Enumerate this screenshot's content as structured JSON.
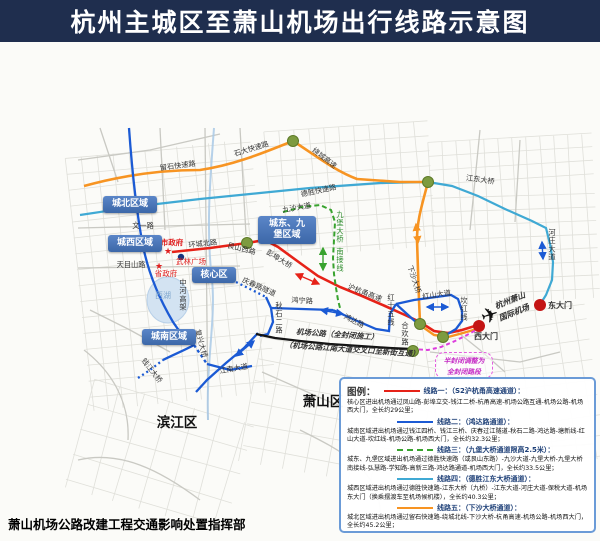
{
  "header": {
    "title": "杭州主城区至萧山机场出行线路示意图"
  },
  "footer": {
    "issuer": "萧山机场公路改建工程交通影响处置指挥部"
  },
  "legend": {
    "title": "图例：",
    "routes": [
      {
        "name": "线路一：（S2沪杭甬高速通道）：",
        "style": "solid",
        "color": "#e62218",
        "desc": "核心区进出机场通过凤山路-彭埠立交-钱江二桥-杭甬高速-机场公路互通-机场公路-机场西大门，全长约29公里；"
      },
      {
        "name": "线路二：（鸿达路通道）：",
        "style": "solid",
        "color": "#1b5ad4",
        "desc": "城南区域进出机场通过钱江四桥、钱江三桥、庆春过江隧道-秋石二路-鸿达路-塘新线-红山大道-坎红线-机场公路-机场西大门，全长约32.3公里；"
      },
      {
        "name": "线路三：（九堡大桥通道限高2.5米）：",
        "style": "dashed",
        "color": "#38a32e",
        "desc": "城东、九堡区域进出机场通过德胜快速路（或艮山东路）-九沙大道-九堡大桥-九堡大桥南接线-弘慧路-学知路-高新三路-鸿达路通道-机场西大门，全长约33.5公里；"
      },
      {
        "name": "线路四：（德胜江东大桥通道）：",
        "style": "solid",
        "color": "#3fa9d4",
        "desc": "城西区域进出机场通过德胜快速路-江东大桥（九桥）-江东大道-河庄大道-保税大道-机场东大门（换乘摆渡车至机场候机楼），全长约40.3公里；"
      },
      {
        "name": "线路五：（下沙大桥通道）：",
        "style": "solid",
        "color": "#f79422",
        "desc": "城北区域进出机场通过留石快速路-绕城北线-下沙大桥-杭甬高速-机场公路-机场西大门，全长约45.2公里；"
      }
    ]
  },
  "map": {
    "regions": [
      {
        "label": "城北区域",
        "x": 103,
        "y": 196,
        "w": 54,
        "h": 17
      },
      {
        "label": "城西区域",
        "x": 108,
        "y": 235,
        "w": 54,
        "h": 17
      },
      {
        "label": "核心区",
        "x": 192,
        "y": 267,
        "w": 44,
        "h": 16
      },
      {
        "label": "城南区域",
        "x": 142,
        "y": 329,
        "w": 54,
        "h": 16
      },
      {
        "label": "城东、九\n堡区域",
        "x": 258,
        "y": 216,
        "w": 58,
        "h": 28
      }
    ],
    "notes": {
      "adjust_note": "半封闭调整为\n全封闭路段"
    },
    "labels": [
      {
        "t": "留石快速路",
        "x": 178,
        "y": 168,
        "r": -7,
        "n": "road-label-liushi-expressway"
      },
      {
        "t": "石大快速路",
        "x": 252,
        "y": 151,
        "r": -17,
        "n": "road-label-shida-expressway"
      },
      {
        "t": "绕城高速",
        "x": 323,
        "y": 160,
        "r": 38,
        "n": "road-label-ring-expressway"
      },
      {
        "t": "德胜快速路",
        "x": 319,
        "y": 193,
        "r": -12,
        "n": "road-label-desheng-expressway"
      },
      {
        "t": "九沙大道",
        "x": 297,
        "y": 210,
        "r": -10,
        "n": "road-label-jiusha-avenue"
      },
      {
        "t": "江东大桥",
        "x": 480,
        "y": 182,
        "r": 8,
        "n": "road-label-jiangdong-bridge"
      },
      {
        "t": "河庄大道",
        "x": 552,
        "y": 235,
        "v": 1,
        "n": "road-label-hezhuang-avenue"
      },
      {
        "t": "九堡大桥",
        "x": 340,
        "y": 217,
        "v": 1,
        "c": "#2a8a2a",
        "n": "road-label-jiubao-bridge"
      },
      {
        "t": "南接线",
        "x": 340,
        "y": 254,
        "v": 1,
        "c": "#2a8a2a",
        "n": "road-label-south-link"
      },
      {
        "t": "文一路",
        "x": 143,
        "y": 228,
        "n": "road-label-wenyi-road"
      },
      {
        "t": "天目山路",
        "x": 131,
        "y": 267,
        "n": "road-label-tianmushan-road"
      },
      {
        "t": "环城北路",
        "x": 203,
        "y": 246,
        "r": -6,
        "n": "road-label-huancheng-north-road"
      },
      {
        "t": "艮山西路",
        "x": 241,
        "y": 251,
        "r": 14,
        "n": "road-label-genshan-west-road"
      },
      {
        "t": "彭埠大桥",
        "x": 278,
        "y": 261,
        "r": 32,
        "n": "road-label-pengbu-bridge"
      },
      {
        "t": "庆春路隧道",
        "x": 258,
        "y": 289,
        "r": 24,
        "n": "road-label-qingchun-tunnel"
      },
      {
        "t": "鸿宁路",
        "x": 302,
        "y": 303,
        "r": 3,
        "n": "road-label-hongning-road"
      },
      {
        "t": "沪杭甬高速",
        "x": 364,
        "y": 295,
        "r": 21,
        "n": "road-label-huhangyong-expressway"
      },
      {
        "t": "鸿达路",
        "x": 353,
        "y": 323,
        "r": 27,
        "n": "road-label-hongda-road"
      },
      {
        "t": "秋石二路",
        "x": 279,
        "y": 308,
        "v": 1,
        "n": "road-label-qiushi-2nd-road"
      },
      {
        "t": "红十五线",
        "x": 391,
        "y": 300,
        "v": 1,
        "n": "road-label-hong15-line"
      },
      {
        "t": "合欢路",
        "x": 405,
        "y": 328,
        "v": 1,
        "n": "road-label-hehuan-road"
      },
      {
        "t": "坎红线",
        "x": 464,
        "y": 303,
        "v": 1,
        "n": "road-label-kanhong-line"
      },
      {
        "t": "红山大道",
        "x": 437,
        "y": 297,
        "r": -8,
        "n": "road-label-hongshan-avenue"
      },
      {
        "t": "下沙大桥",
        "x": 412,
        "y": 280,
        "r": 72,
        "n": "road-label-xiasha-bridge"
      },
      {
        "t": "中河高架",
        "x": 183,
        "y": 285,
        "v": 1,
        "n": "road-label-zhonghe-viaduct"
      },
      {
        "t": "复兴大桥",
        "x": 199,
        "y": 344,
        "r": 75,
        "n": "road-label-fuxing-bridge"
      },
      {
        "t": "钱江大桥",
        "x": 150,
        "y": 372,
        "r": 52,
        "n": "road-label-qianjiang-bridge"
      },
      {
        "t": "江南大道",
        "x": 234,
        "y": 371,
        "r": -10,
        "n": "road-label-jiangnan-avenue"
      },
      {
        "t": "西湖",
        "x": 163,
        "y": 298,
        "c": "#7ea6cc",
        "s": 8,
        "n": "west-lake-label"
      },
      {
        "t": "市政府",
        "x": 172,
        "y": 245,
        "c": "#e02020",
        "s": 7.5,
        "b": 1,
        "n": "poi-city-government"
      },
      {
        "t": "武林广场",
        "x": 191,
        "y": 264,
        "c": "#e02020",
        "s": 7.5,
        "n": "poi-wulin-square"
      },
      {
        "t": "省政府",
        "x": 166,
        "y": 276,
        "c": "#e02020",
        "s": 7.5,
        "n": "poi-provincial-government"
      },
      {
        "t": "东大门",
        "x": 560,
        "y": 308,
        "s": 8,
        "b": 1,
        "n": "airport-east-gate-label"
      },
      {
        "t": "西大门",
        "x": 486,
        "y": 339,
        "s": 8,
        "b": 1,
        "n": "airport-west-gate-label"
      },
      {
        "t": "滨江区",
        "x": 177,
        "y": 427,
        "s": 13.5,
        "b": 1,
        "c": "#111111",
        "n": "district-binjiang-label"
      },
      {
        "t": "萧山区",
        "x": 323,
        "y": 406,
        "s": 13.5,
        "b": 1,
        "c": "#111111",
        "n": "district-xiaoshan-label"
      },
      {
        "t": "杭州萧山",
        "x": 511,
        "y": 303,
        "r": -22,
        "i": 1,
        "s": 8,
        "b": 1,
        "n": "airport-name-line1"
      },
      {
        "t": "国际机场",
        "x": 515,
        "y": 315,
        "r": -22,
        "i": 1,
        "s": 8,
        "b": 1,
        "n": "airport-name-line2"
      },
      {
        "t": "机场公路（全封闭施工）",
        "x": 337,
        "y": 337,
        "r": 4,
        "i": 1,
        "s": 7.5,
        "b": 1,
        "n": "closure-note-line1"
      },
      {
        "t": "（机场公路江南大道交叉口至新街互通）",
        "x": 352,
        "y": 352,
        "r": 4,
        "i": 1,
        "s": 7.5,
        "b": 1,
        "n": "closure-note-line2"
      }
    ]
  }
}
